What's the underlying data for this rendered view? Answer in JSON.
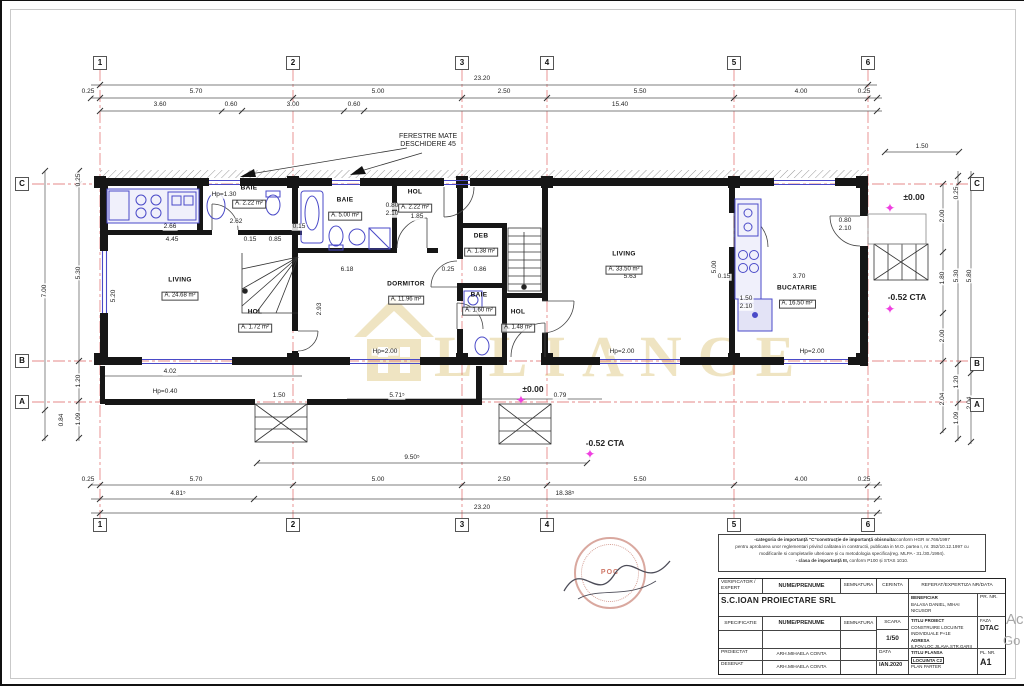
{
  "annotation": {
    "line1": "FERESTRE MATE",
    "line2": "DESCHIDERE 45"
  },
  "watermark": {
    "text": "LLIANCE",
    "color": "#e2cf92"
  },
  "corner_marks": {
    "mark1": "Ac",
    "mark2": "Go"
  },
  "stamp": {
    "center": "POC"
  },
  "grid": {
    "top": [
      {
        "x": 98,
        "t": "1"
      },
      {
        "x": 291,
        "t": "2"
      },
      {
        "x": 460,
        "t": "3"
      },
      {
        "x": 545,
        "t": "4"
      },
      {
        "x": 732,
        "t": "5"
      },
      {
        "x": 866,
        "t": "6"
      }
    ],
    "bottom": [
      {
        "x": 98,
        "t": "1"
      },
      {
        "x": 291,
        "t": "2"
      },
      {
        "x": 460,
        "t": "3"
      },
      {
        "x": 545,
        "t": "4"
      },
      {
        "x": 732,
        "t": "5"
      },
      {
        "x": 866,
        "t": "6"
      }
    ],
    "left": [
      {
        "y": 183,
        "t": "C"
      },
      {
        "y": 360,
        "t": "B"
      },
      {
        "y": 401,
        "t": "A"
      }
    ],
    "right": [
      {
        "y": 183,
        "t": "C"
      },
      {
        "y": 363,
        "t": "B"
      },
      {
        "y": 404,
        "t": "A"
      }
    ]
  },
  "rooms": [
    {
      "x": 178,
      "y": 288,
      "name": "LIVING",
      "area": "A. 24.68 m²"
    },
    {
      "x": 247,
      "y": 196,
      "name": "BAIE",
      "area": "A. 2.22 m²"
    },
    {
      "x": 343,
      "y": 208,
      "name": "BAIE",
      "area": "A. 5.00 m²"
    },
    {
      "x": 413,
      "y": 200,
      "name": "HOL",
      "area": "A. 2.22 m²"
    },
    {
      "x": 404,
      "y": 292,
      "name": "DORMITOR",
      "area": "A. 11.96 m²"
    },
    {
      "x": 479,
      "y": 244,
      "name": "DEB",
      "area": "A. 1.38 m²"
    },
    {
      "x": 477,
      "y": 303,
      "name": "BAIE",
      "area": "A. 1.60 m²"
    },
    {
      "x": 516,
      "y": 320,
      "name": "HOL",
      "area": "A. 1.48 m²"
    },
    {
      "x": 253,
      "y": 320,
      "name": "HOL",
      "area": "A. 1.72 m²"
    },
    {
      "x": 622,
      "y": 262,
      "name": "LIVING",
      "area": "A. 33.50 m²"
    },
    {
      "x": 795,
      "y": 296,
      "name": "BUCATARIE",
      "area": "A. 16.50 m²"
    }
  ],
  "dims": [
    {
      "x": 480,
      "y": 78,
      "t": "23.20"
    },
    {
      "x": 86,
      "y": 91,
      "t": "0.25"
    },
    {
      "x": 194,
      "y": 91,
      "t": "5.70"
    },
    {
      "x": 376,
      "y": 91,
      "t": "5.00"
    },
    {
      "x": 502,
      "y": 91,
      "t": "2.50"
    },
    {
      "x": 638,
      "y": 91,
      "t": "5.50"
    },
    {
      "x": 799,
      "y": 91,
      "t": "4.00"
    },
    {
      "x": 862,
      "y": 91,
      "t": "0.25"
    },
    {
      "x": 158,
      "y": 104,
      "t": "3.60"
    },
    {
      "x": 229,
      "y": 104,
      "t": "0.60"
    },
    {
      "x": 291,
      "y": 104,
      "t": "3.00"
    },
    {
      "x": 352,
      "y": 104,
      "t": "0.60"
    },
    {
      "x": 618,
      "y": 104,
      "t": "15.40"
    },
    {
      "x": 920,
      "y": 146,
      "t": "1.50"
    },
    {
      "x": 86,
      "y": 479,
      "t": "0.25"
    },
    {
      "x": 194,
      "y": 479,
      "t": "5.70"
    },
    {
      "x": 376,
      "y": 479,
      "t": "5.00"
    },
    {
      "x": 502,
      "y": 479,
      "t": "2.50"
    },
    {
      "x": 638,
      "y": 479,
      "t": "5.50"
    },
    {
      "x": 799,
      "y": 479,
      "t": "4.00"
    },
    {
      "x": 862,
      "y": 479,
      "t": "0.25"
    },
    {
      "x": 176,
      "y": 493,
      "t": "4.81⁵"
    },
    {
      "x": 563,
      "y": 493,
      "t": "18.38⁵"
    },
    {
      "x": 480,
      "y": 507,
      "t": "23.20"
    },
    {
      "x": 410,
      "y": 457,
      "t": "9.50⁵"
    },
    {
      "x": 43,
      "y": 290,
      "t": "7.00",
      "r": -90
    },
    {
      "x": 60,
      "y": 419,
      "t": "0.84",
      "r": -90
    },
    {
      "x": 77,
      "y": 179,
      "t": "0.25",
      "r": -90
    },
    {
      "x": 77,
      "y": 272,
      "t": "5.30",
      "r": -90
    },
    {
      "x": 77,
      "y": 380,
      "t": "1.20",
      "r": -90
    },
    {
      "x": 77,
      "y": 418,
      "t": "1.09",
      "r": -90
    },
    {
      "x": 941,
      "y": 215,
      "t": "2.00",
      "r": -90
    },
    {
      "x": 941,
      "y": 277,
      "t": "1.80",
      "r": -90
    },
    {
      "x": 941,
      "y": 335,
      "t": "2.00",
      "r": -90
    },
    {
      "x": 941,
      "y": 398,
      "t": "2.04",
      "r": -90
    },
    {
      "x": 955,
      "y": 192,
      "t": "0.25",
      "r": -90
    },
    {
      "x": 955,
      "y": 275,
      "t": "5.30",
      "r": -90
    },
    {
      "x": 955,
      "y": 381,
      "t": "1.20",
      "r": -90
    },
    {
      "x": 955,
      "y": 417,
      "t": "1.09",
      "r": -90
    },
    {
      "x": 968,
      "y": 275,
      "t": "5.80",
      "r": -90
    },
    {
      "x": 968,
      "y": 402,
      "t": "2.04",
      "r": -90
    },
    {
      "x": 168,
      "y": 226,
      "t": "2.66"
    },
    {
      "x": 297,
      "y": 226,
      "t": "0.15"
    },
    {
      "x": 234,
      "y": 221,
      "t": "2.62"
    },
    {
      "x": 170,
      "y": 239,
      "t": "4.45"
    },
    {
      "x": 248,
      "y": 239,
      "t": "0.15"
    },
    {
      "x": 273,
      "y": 239,
      "t": "0.85"
    },
    {
      "x": 415,
      "y": 216,
      "t": "1.85"
    },
    {
      "x": 345,
      "y": 269,
      "t": "6.18"
    },
    {
      "x": 446,
      "y": 269,
      "t": "0.25"
    },
    {
      "x": 478,
      "y": 269,
      "t": "0.86"
    },
    {
      "x": 628,
      "y": 276,
      "t": "5.63"
    },
    {
      "x": 722,
      "y": 276,
      "t": "0.15"
    },
    {
      "x": 797,
      "y": 276,
      "t": "3.70"
    },
    {
      "x": 395,
      "y": 395,
      "t": "5.71⁵"
    },
    {
      "x": 558,
      "y": 395,
      "t": "0.79"
    },
    {
      "x": 168,
      "y": 371,
      "t": "4.02"
    },
    {
      "x": 163,
      "y": 391,
      "t": "Hp=0.40"
    },
    {
      "x": 277,
      "y": 395,
      "t": "1.50"
    },
    {
      "x": 383,
      "y": 351,
      "t": "Hp=2.00"
    },
    {
      "x": 620,
      "y": 351,
      "t": "Hp=2.00"
    },
    {
      "x": 810,
      "y": 351,
      "t": "Hp=2.00"
    },
    {
      "x": 222,
      "y": 194,
      "t": "Hp=1.30"
    },
    {
      "x": 713,
      "y": 266,
      "t": "5.00",
      "r": -90
    },
    {
      "x": 318,
      "y": 308,
      "t": "2.93",
      "r": -90
    },
    {
      "x": 112,
      "y": 295,
      "t": "5.20",
      "r": -90
    },
    {
      "x": 744,
      "y": 298,
      "t": "1.50"
    },
    {
      "x": 744,
      "y": 306,
      "t": "2.10"
    },
    {
      "x": 843,
      "y": 220,
      "t": "0.80"
    },
    {
      "x": 843,
      "y": 228,
      "t": "2.10"
    },
    {
      "x": 390,
      "y": 205,
      "t": "0.80"
    },
    {
      "x": 390,
      "y": 213,
      "t": "2.10"
    }
  ],
  "elevations": [
    {
      "x": 912,
      "y": 196,
      "t": "±0.00"
    },
    {
      "x": 905,
      "y": 296,
      "t": "-0.52 CTA"
    },
    {
      "x": 531,
      "y": 388,
      "t": "±0.00"
    },
    {
      "x": 603,
      "y": 442,
      "t": "-0.52 CTA"
    }
  ],
  "stars": [
    {
      "x": 888,
      "y": 207
    },
    {
      "x": 888,
      "y": 308
    },
    {
      "x": 519,
      "y": 399
    },
    {
      "x": 588,
      "y": 453
    }
  ],
  "note": {
    "l1a": "-categoria de importanță \"C\"construcție de importanță obisnuita:",
    "l1b": "conform HGR nr.766/1997",
    "l2": "pentru aprobarea unor reglementari privind calitatea in constructii, publicata in M.O. partea I, nr. 352/10.12.1997 cu",
    "l3": "modificarile si completarile ulterioare și cu metodologia specifica(reg. MLPA - 31./30./1994).",
    "l4a": "- clasa de importanță III,",
    "l4b": " conform P100 și STAS 1010."
  },
  "titleblock": {
    "h_verificator": "VERIFICATOR / EXPERT",
    "h_nume1": "NUME/PRENUME",
    "h_semnatura1": "SEMNATURA",
    "h_cerinta": "CERINTA",
    "h_referat": "REFERAT/EXPERTIZA NR/DATA",
    "company": "S.C.IOAN PROIECTARE SRL",
    "beneficiar_label": "BENEFICIAR",
    "beneficiar_1": "BALASA DANIEL, MIHAI NICUSOR",
    "beneficiar_2": "RADU LAURENTIU MIHAI",
    "pr_nr_label": "PR. NR.",
    "h_specificatie": "SPECIFICATIE",
    "h_nume2": "NUME/PRENUME",
    "h_semnatura2": "SEMNATURA",
    "scara_label": "SCARA",
    "scara_value": "1/50",
    "titlu_proiect_label": "TITLU PROIECT",
    "titlu_proiect_1": "CONSTRUIRE LOCUINTE",
    "titlu_proiect_2": "INDIVIDUALE P+1E",
    "adresa_label": "ADRESA",
    "adresa_1": "ILFOV,LOC.JILAVA,STR.GARII",
    "adresa_2": "NR.31 LOT 4",
    "faza_label": "FAZA",
    "faza_value": "DTAC",
    "proiectat_label": "PROIECTAT",
    "proiectat_name": "ARH.MIHAELA CONTA",
    "desenat_label": "DESENAT",
    "desenat_name": "ARH.MIHAELA CONTA",
    "data_label": "DATA",
    "data_value": "IAN.2020",
    "titlu_plansa_label": "TITLU PLANSA",
    "plansa_badge": "LOCUINTA C2",
    "plansa_value": "PLAN PARTER",
    "pl_nr_label": "PL. NR.",
    "pl_nr_value": "A1"
  }
}
